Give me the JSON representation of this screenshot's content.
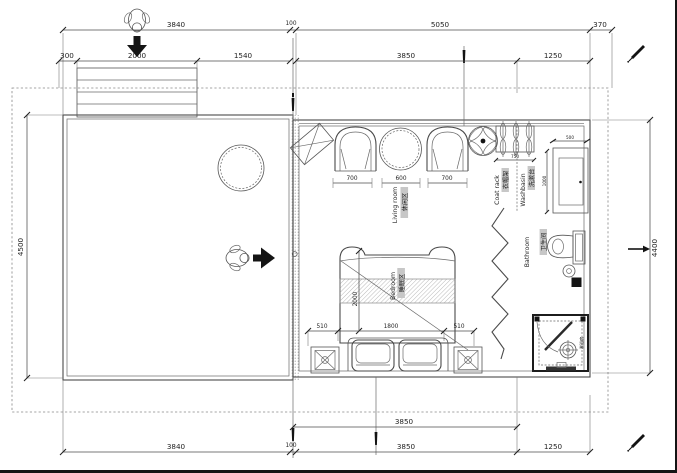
{
  "drawing": {
    "type": "floor-plan",
    "dims": {
      "top1": [
        "3840",
        "100",
        "5050",
        "370"
      ],
      "top2": [
        "300",
        "2000",
        "1540",
        "3850",
        "1250"
      ],
      "left": "4500",
      "right": "4400",
      "bottom1": "3850",
      "bottom2": [
        "3840",
        "100",
        "3850",
        "1250"
      ],
      "sofa": [
        "700",
        "600",
        "700"
      ],
      "coat_rack": "750",
      "basin_width": "500",
      "basin_depth": "1000",
      "bed": [
        "510",
        "1800",
        "510"
      ],
      "bed_length": "2000"
    },
    "labels": {
      "living_cn": "休闲区",
      "living_en": "Living room",
      "bedroom_cn": "睡眠区",
      "bedroom_en": "Bedroom",
      "bathroom_cn": "卫生间",
      "bathroom_en": "Bathroom",
      "washbasin_cn": "洗漱台",
      "washbasin_en": "Washbasin",
      "coatrack_cn": "衣帽架",
      "coatrack_en": "Coat rack",
      "shower_cn": "淋浴房"
    },
    "colors": {
      "line": "#4a4a4a",
      "accent_black": "#141414",
      "highlight": "#c7c7c7"
    }
  }
}
